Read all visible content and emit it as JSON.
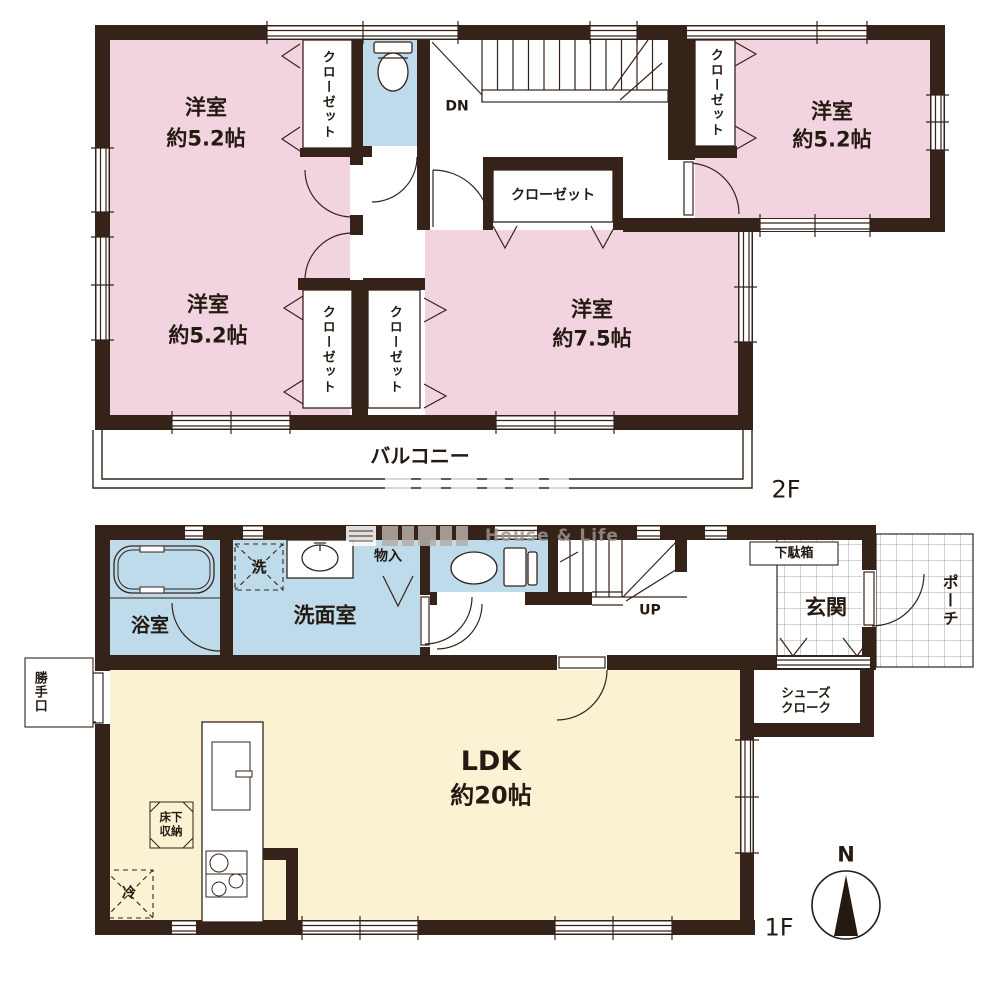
{
  "f2": {
    "label": "2F",
    "rooms": {
      "nw": {
        "name": "洋室",
        "size": "約5.2帖"
      },
      "ne": {
        "name": "洋室",
        "size": "約5.2帖"
      },
      "sw": {
        "name": "洋室",
        "size": "約5.2帖"
      },
      "se": {
        "name": "洋室",
        "size": "約7.5帖"
      }
    },
    "closet": "クローゼット",
    "balcony": "バルコニー",
    "stairs_down": "DN"
  },
  "f1": {
    "label": "1F",
    "ldk": {
      "name": "LDK",
      "size": "約20帖"
    },
    "bath": "浴室",
    "laundry": "洗",
    "washroom": "洗面室",
    "storage": "物入",
    "stairs_up": "UP",
    "shoe_box": "下駄箱",
    "entrance": "玄関",
    "porch": "ポーチ",
    "shoe_cloak": [
      "シューズ",
      "クローク"
    ],
    "back_door": "勝手口",
    "underfloor": [
      "床下",
      "収納"
    ],
    "fridge": "冷"
  },
  "compass": {
    "north": "N"
  },
  "watermark": "House & Life",
  "colors": {
    "room_pink": "#f2d4e0",
    "wet_blue": "#bedbeb",
    "ldk_cream": "#fbf1d3",
    "wall": "#35231a"
  }
}
